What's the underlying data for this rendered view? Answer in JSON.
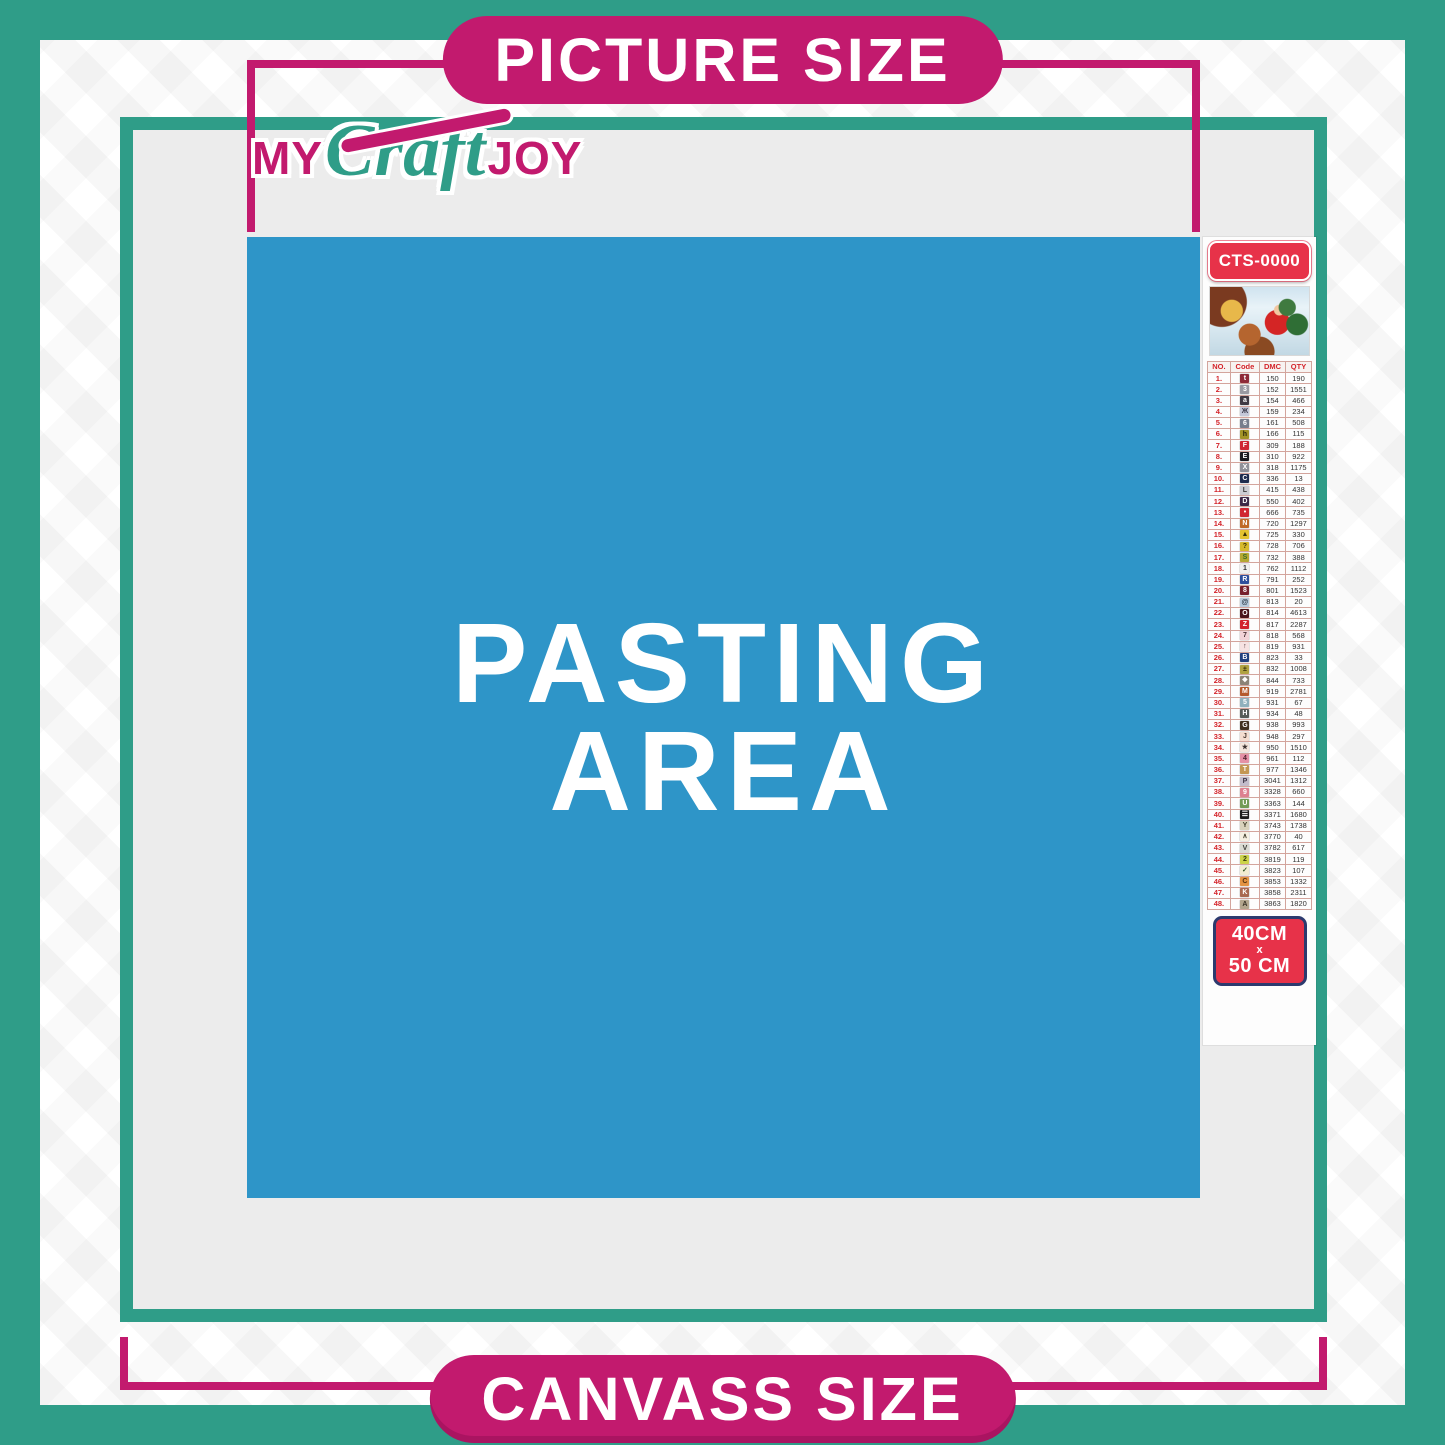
{
  "banners": {
    "top": "PICTURE SIZE",
    "bottom": "CANVASS SIZE"
  },
  "logo": {
    "word1": "MY",
    "word2": "Craft",
    "word3": "JOY"
  },
  "pasting_area": {
    "line1": "PASTING",
    "line2": "AREA"
  },
  "product": {
    "code": "CTS-0000",
    "size": {
      "line1": "40CM",
      "line2": "x",
      "line3": "50 CM"
    }
  },
  "colors": {
    "teal": "#2f9d88",
    "magenta": "#c21a6e",
    "blue": "#2e95c8",
    "red": "#e73249",
    "navy_border": "#2c3a6e",
    "gray_area": "#ececec",
    "table_red": "#d4232a"
  },
  "color_chart": {
    "headers": [
      "NO.",
      "Code",
      "DMC",
      "QTY"
    ],
    "rows": [
      {
        "no": "1.",
        "symbol": "t",
        "bg": "#8e2a38",
        "fg": "#ffffff",
        "dmc": "150",
        "qty": "190"
      },
      {
        "no": "2.",
        "symbol": "3",
        "bg": "#9a9aa2",
        "fg": "#ffffff",
        "dmc": "152",
        "qty": "1551"
      },
      {
        "no": "3.",
        "symbol": "a",
        "bg": "#403a44",
        "fg": "#ffffff",
        "dmc": "154",
        "qty": "466"
      },
      {
        "no": "4.",
        "symbol": "Ж",
        "bg": "#c4c8d8",
        "fg": "#3a3a4a",
        "dmc": "159",
        "qty": "234"
      },
      {
        "no": "5.",
        "symbol": "6",
        "bg": "#787e8c",
        "fg": "#ffffff",
        "dmc": "161",
        "qty": "508"
      },
      {
        "no": "6.",
        "symbol": "h",
        "bg": "#a39427",
        "fg": "#26220a",
        "dmc": "166",
        "qty": "115"
      },
      {
        "no": "7.",
        "symbol": "F",
        "bg": "#cf2533",
        "fg": "#ffffff",
        "dmc": "309",
        "qty": "188"
      },
      {
        "no": "8.",
        "symbol": "E",
        "bg": "#1b1a20",
        "fg": "#ffffff",
        "dmc": "310",
        "qty": "922"
      },
      {
        "no": "9.",
        "symbol": "X",
        "bg": "#8f9098",
        "fg": "#ffffff",
        "dmc": "318",
        "qty": "1175"
      },
      {
        "no": "10.",
        "symbol": "C",
        "bg": "#1f2c4e",
        "fg": "#ffffff",
        "dmc": "336",
        "qty": "13"
      },
      {
        "no": "11.",
        "symbol": "L",
        "bg": "#ccccd2",
        "fg": "#3a3a3a",
        "dmc": "415",
        "qty": "438"
      },
      {
        "no": "12.",
        "symbol": "D",
        "bg": "#3d2746",
        "fg": "#ffffff",
        "dmc": "550",
        "qty": "402"
      },
      {
        "no": "13.",
        "symbol": "•",
        "bg": "#d02531",
        "fg": "#ffffff",
        "dmc": "666",
        "qty": "735"
      },
      {
        "no": "14.",
        "symbol": "N",
        "bg": "#c06a28",
        "fg": "#ffffff",
        "dmc": "720",
        "qty": "1297"
      },
      {
        "no": "15.",
        "symbol": "▲",
        "bg": "#e3c32e",
        "fg": "#3a3208",
        "dmc": "725",
        "qty": "330"
      },
      {
        "no": "16.",
        "symbol": "?",
        "bg": "#d6b92b",
        "fg": "#3a3208",
        "dmc": "728",
        "qty": "706"
      },
      {
        "no": "17.",
        "symbol": "S",
        "bg": "#b5a832",
        "fg": "#3a6e28",
        "dmc": "732",
        "qty": "388"
      },
      {
        "no": "18.",
        "symbol": "1",
        "bg": "#f0f0ee",
        "fg": "#333333",
        "dmc": "762",
        "qty": "1112"
      },
      {
        "no": "19.",
        "symbol": "R",
        "bg": "#2d4f9c",
        "fg": "#ffffff",
        "dmc": "791",
        "qty": "252"
      },
      {
        "no": "20.",
        "symbol": "8",
        "bg": "#77202c",
        "fg": "#ffffff",
        "dmc": "801",
        "qty": "1523"
      },
      {
        "no": "21.",
        "symbol": "@",
        "bg": "#b7c9da",
        "fg": "#2e3a46",
        "dmc": "813",
        "qty": "20"
      },
      {
        "no": "22.",
        "symbol": "O",
        "bg": "#48141a",
        "fg": "#ffffff",
        "dmc": "814",
        "qty": "4613"
      },
      {
        "no": "23.",
        "symbol": "Z",
        "bg": "#d2222e",
        "fg": "#ffffff",
        "dmc": "817",
        "qty": "2287"
      },
      {
        "no": "24.",
        "symbol": "7",
        "bg": "#f2d3d8",
        "fg": "#4a3236",
        "dmc": "818",
        "qty": "568"
      },
      {
        "no": "25.",
        "symbol": "↑",
        "bg": "#f6e2e2",
        "fg": "#4a3236",
        "dmc": "819",
        "qty": "931"
      },
      {
        "no": "26.",
        "symbol": "B",
        "bg": "#20407e",
        "fg": "#ffffff",
        "dmc": "823",
        "qty": "33"
      },
      {
        "no": "27.",
        "symbol": "±",
        "bg": "#b0a242",
        "fg": "#2e2a0a",
        "dmc": "832",
        "qty": "1008"
      },
      {
        "no": "28.",
        "symbol": "❖",
        "bg": "#8c8377",
        "fg": "#ffffff",
        "dmc": "844",
        "qty": "733"
      },
      {
        "no": "29.",
        "symbol": "M",
        "bg": "#b55a2c",
        "fg": "#ffffff",
        "dmc": "919",
        "qty": "2781"
      },
      {
        "no": "30.",
        "symbol": "5",
        "bg": "#8fb0bc",
        "fg": "#ffffff",
        "dmc": "931",
        "qty": "67"
      },
      {
        "no": "31.",
        "symbol": "H",
        "bg": "#565c58",
        "fg": "#ffffff",
        "dmc": "934",
        "qty": "48"
      },
      {
        "no": "32.",
        "symbol": "G",
        "bg": "#40301f",
        "fg": "#ffffff",
        "dmc": "938",
        "qty": "993"
      },
      {
        "no": "33.",
        "symbol": "J",
        "bg": "#f4ddd0",
        "fg": "#4a3a32",
        "dmc": "948",
        "qty": "297"
      },
      {
        "no": "34.",
        "symbol": "★",
        "bg": "#f3e6dc",
        "fg": "#3a3230",
        "dmc": "950",
        "qty": "1510"
      },
      {
        "no": "35.",
        "symbol": "4",
        "bg": "#e590a6",
        "fg": "#4a1e2a",
        "dmc": "961",
        "qty": "112"
      },
      {
        "no": "36.",
        "symbol": "T",
        "bg": "#c49754",
        "fg": "#ffffff",
        "dmc": "977",
        "qty": "1346"
      },
      {
        "no": "37.",
        "symbol": "P",
        "bg": "#c3bccb",
        "fg": "#3e3646",
        "dmc": "3041",
        "qty": "1312"
      },
      {
        "no": "38.",
        "symbol": "9",
        "bg": "#dd8090",
        "fg": "#ffffff",
        "dmc": "3328",
        "qty": "660"
      },
      {
        "no": "39.",
        "symbol": "U",
        "bg": "#729c57",
        "fg": "#ffffff",
        "dmc": "3363",
        "qty": "144"
      },
      {
        "no": "40.",
        "symbol": "☰",
        "bg": "#1c1c1c",
        "fg": "#ffffff",
        "dmc": "3371",
        "qty": "1680"
      },
      {
        "no": "41.",
        "symbol": "Y",
        "bg": "#d9d2bb",
        "fg": "#44402e",
        "dmc": "3743",
        "qty": "1738"
      },
      {
        "no": "42.",
        "symbol": "∧",
        "bg": "#f6f0e2",
        "fg": "#44402e",
        "dmc": "3770",
        "qty": "40"
      },
      {
        "no": "43.",
        "symbol": "V",
        "bg": "#dadbd2",
        "fg": "#3e3e3a",
        "dmc": "3782",
        "qty": "617"
      },
      {
        "no": "44.",
        "symbol": "2",
        "bg": "#ccd34a",
        "fg": "#343a0a",
        "dmc": "3819",
        "qty": "119"
      },
      {
        "no": "45.",
        "symbol": "✓",
        "bg": "#f2ecd2",
        "fg": "#375a2a",
        "dmc": "3823",
        "qty": "107"
      },
      {
        "no": "46.",
        "symbol": "C",
        "bg": "#e39343",
        "fg": "#53320f",
        "dmc": "3853",
        "qty": "1332"
      },
      {
        "no": "47.",
        "symbol": "K",
        "bg": "#a96a52",
        "fg": "#ffffff",
        "dmc": "3858",
        "qty": "2311"
      },
      {
        "no": "48.",
        "symbol": "A",
        "bg": "#b3a58d",
        "fg": "#3a3328",
        "dmc": "3863",
        "qty": "1820"
      }
    ]
  }
}
